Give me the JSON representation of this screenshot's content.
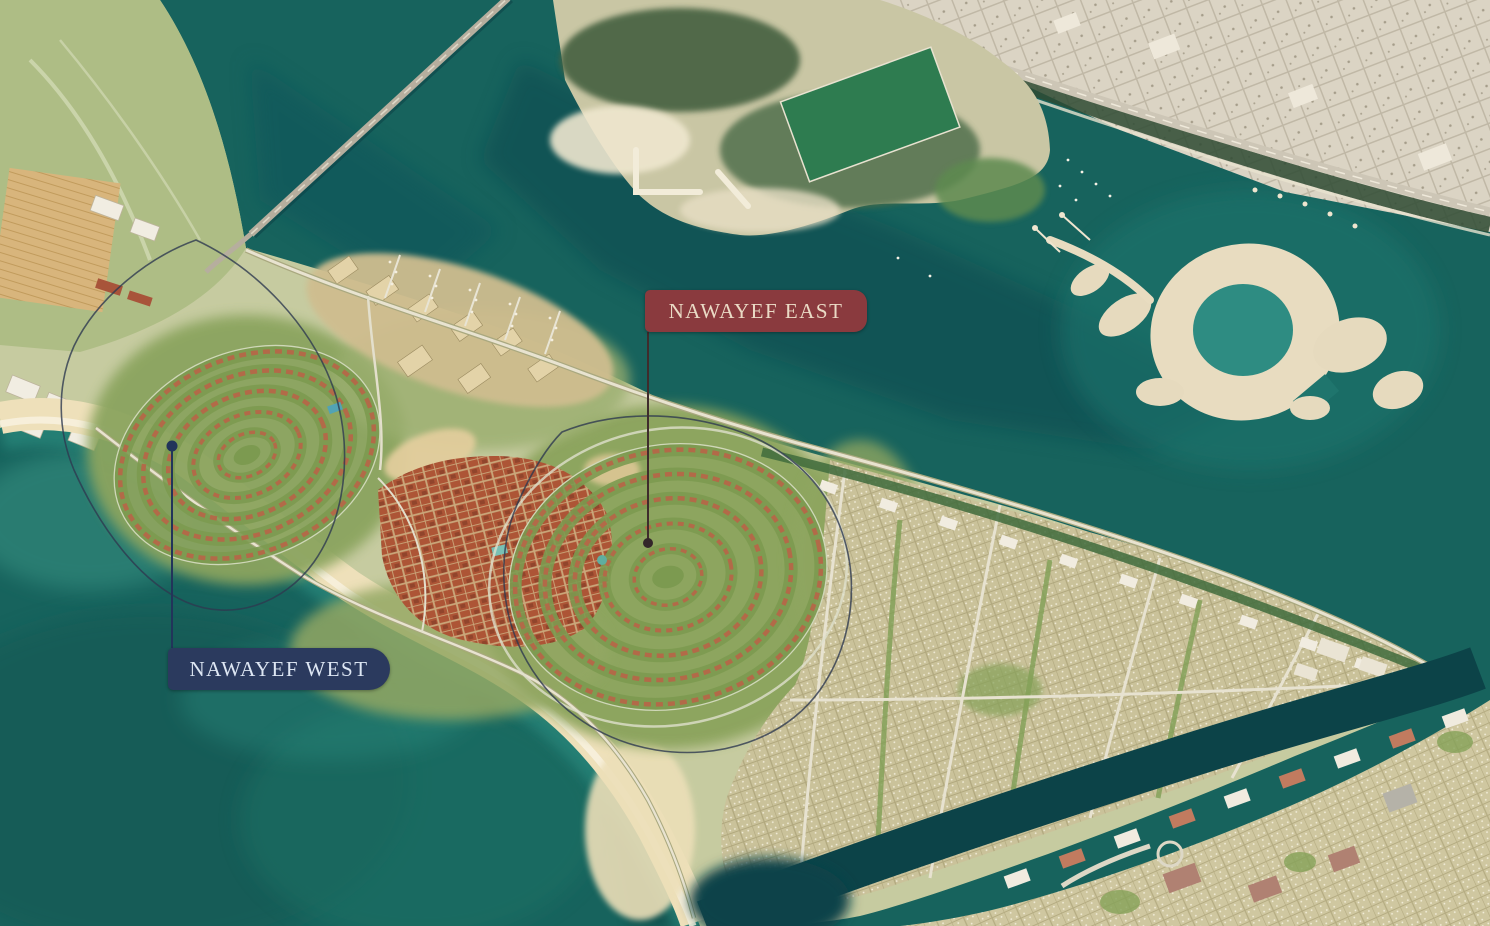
{
  "map": {
    "labels": [
      {
        "text": "NAWAYEF EAST",
        "bg": "#8a3a3e",
        "color": "#eadac5"
      },
      {
        "text": "NAWAYEF WEST",
        "bg": "#2b3a5e",
        "color": "#dde6f3"
      }
    ],
    "colors": {
      "water_deep": "#0d4a4f",
      "water": "#17635d",
      "water_shallow": "#3f9c8b",
      "beach_sand": "#eee0ba",
      "island_green": "#8ba45e",
      "terracotta_village": "#ad5536",
      "suburb": "#cac29a",
      "city_blocks": "#dbd4c4",
      "dark_vegetation": "#44603f",
      "sports_field": "#2e7c50",
      "lagoon": "#2e8c82",
      "east_label_leader": "#33262a",
      "west_label_leader": "#22345a"
    }
  }
}
